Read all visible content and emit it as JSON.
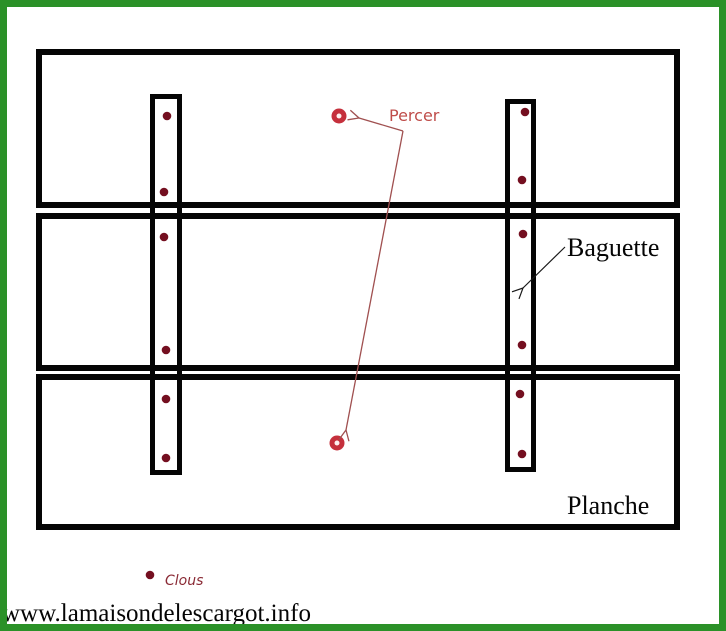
{
  "labels": {
    "percer": "Percer",
    "baguette": "Baguette",
    "planche": "Planche",
    "clous": "Clous",
    "watermark": "www.lamaisondelescargot.info"
  },
  "colors": {
    "border_green": "#2b9128",
    "outline_black": "#050505",
    "nail_dot": "#740f20",
    "drill_circle": "#c5303c",
    "drill_hole_center": "#fdf0ef",
    "percer_text": "#bf4d4a",
    "clous_text": "#8a2a35",
    "arrow_red": "#a05050"
  },
  "diagram": {
    "nail_radius": 4.3,
    "drill_outer_radius": 7.5,
    "drill_inner_radius": 2.5,
    "nails": [
      [
        167,
        116
      ],
      [
        164,
        192
      ],
      [
        164,
        237
      ],
      [
        166,
        350
      ],
      [
        166,
        399
      ],
      [
        166,
        458
      ],
      [
        525,
        112
      ],
      [
        522,
        180
      ],
      [
        523,
        234
      ],
      [
        522,
        345
      ],
      [
        520,
        394
      ],
      [
        522,
        454
      ],
      [
        150,
        575
      ]
    ],
    "drill_holes": [
      [
        339,
        116
      ],
      [
        337,
        443
      ]
    ]
  }
}
